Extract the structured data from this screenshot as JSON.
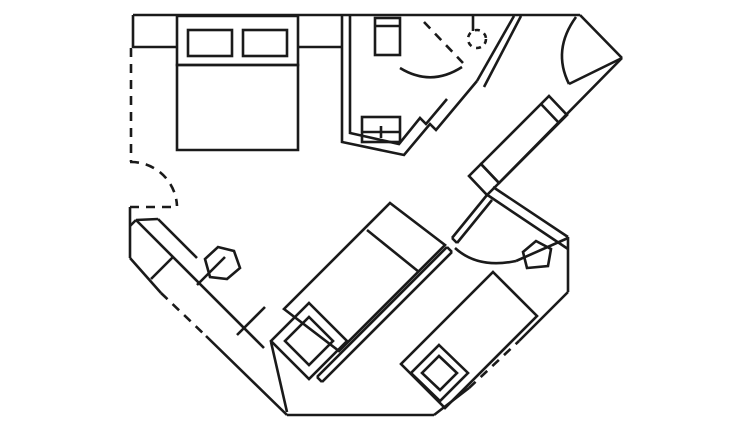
{
  "canvas": {
    "width": 754,
    "height": 435,
    "background_color": "#ffffff",
    "line_color": "#1a1a1a",
    "line_width": 2.6,
    "dash_pattern": "9,7",
    "dash_pattern_small": "5,5"
  },
  "floor_plan": {
    "elements": [
      {
        "name": "top-wall",
        "type": "line",
        "x1": 133,
        "y1": 15,
        "x2": 580,
        "y2": 15
      },
      {
        "name": "left-wall-top",
        "type": "line",
        "x1": 133,
        "y1": 15,
        "x2": 133,
        "y2": 48
      },
      {
        "name": "left-wall-window-dashed",
        "type": "line",
        "dashed": true,
        "x1": 131,
        "y1": 48,
        "x2": 131,
        "y2": 162
      },
      {
        "name": "left-connecting-door-leaf-dashed",
        "type": "line",
        "dashed": true,
        "x1": 130,
        "y1": 207,
        "x2": 177,
        "y2": 207
      },
      {
        "name": "left-connecting-door-arc-dashed",
        "type": "path",
        "dashed": true,
        "d": "M130,162 A46,46 0 0 1 177,206"
      },
      {
        "name": "left-wall-bottom",
        "type": "line",
        "x1": 130,
        "y1": 207,
        "x2": 130,
        "y2": 258
      },
      {
        "name": "lower-left-wall-a",
        "type": "line",
        "x1": 130,
        "y1": 258,
        "x2": 161,
        "y2": 293
      },
      {
        "name": "lower-left-window-dashed",
        "type": "line",
        "dashed": true,
        "x1": 161,
        "y1": 293,
        "x2": 206,
        "y2": 336
      },
      {
        "name": "lower-left-wall-b",
        "type": "line",
        "x1": 206,
        "y1": 336,
        "x2": 287,
        "y2": 415
      },
      {
        "name": "bottom-wall",
        "type": "line",
        "x1": 287,
        "y1": 415,
        "x2": 434,
        "y2": 415
      },
      {
        "name": "lower-right-wall-a",
        "type": "line",
        "x1": 434,
        "y1": 415,
        "x2": 469,
        "y2": 388
      },
      {
        "name": "lower-right-window-dashed",
        "type": "line",
        "dashed": true,
        "x1": 469,
        "y1": 388,
        "x2": 519,
        "y2": 341
      },
      {
        "name": "lower-right-wall-b",
        "type": "line",
        "x1": 519,
        "y1": 341,
        "x2": 568,
        "y2": 292
      },
      {
        "name": "right-wall-vertical",
        "type": "line",
        "x1": 568,
        "y1": 237,
        "x2": 568,
        "y2": 292
      },
      {
        "name": "entry-corner-wall",
        "type": "line",
        "x1": 580,
        "y1": 15,
        "x2": 622,
        "y2": 58
      },
      {
        "name": "entry-door-leaf",
        "type": "line",
        "x1": 622,
        "y1": 58,
        "x2": 569,
        "y2": 84
      },
      {
        "name": "entry-door-arc",
        "type": "path",
        "d": "M576,17 Q552,50 569,84"
      },
      {
        "name": "right-diagonal-wall",
        "type": "line",
        "x1": 622,
        "y1": 58,
        "x2": 499,
        "y2": 183
      },
      {
        "name": "wardrobe",
        "type": "polygon",
        "pts": "549,96 567,115 499,183 481,164"
      },
      {
        "name": "wardrobe-divider",
        "type": "line",
        "x1": 541,
        "y1": 104,
        "x2": 559,
        "y2": 123
      },
      {
        "name": "wall-connector-post",
        "type": "polygon",
        "pts": "481,164 499,183 487,195 469,176"
      },
      {
        "name": "room2-north-wall-outer",
        "type": "line",
        "x1": 493,
        "y1": 187,
        "x2": 568,
        "y2": 237
      },
      {
        "name": "room2-north-wall-inner",
        "type": "line",
        "x1": 486,
        "y1": 194,
        "x2": 568,
        "y2": 249
      },
      {
        "name": "room2-west-wall-outer",
        "type": "line",
        "x1": 487,
        "y1": 195,
        "x2": 452,
        "y2": 238
      },
      {
        "name": "room2-west-wall-inner",
        "type": "line",
        "x1": 492,
        "y1": 200,
        "x2": 457,
        "y2": 243
      },
      {
        "name": "room2-west-wall-cap",
        "type": "line",
        "x1": 452,
        "y1": 238,
        "x2": 457,
        "y2": 243
      },
      {
        "name": "room2-door-arc",
        "type": "path",
        "d": "M455,248 Q478,269 516,261"
      },
      {
        "name": "room2-corner-wall",
        "type": "line",
        "x1": 516,
        "y1": 261,
        "x2": 568,
        "y2": 238
      },
      {
        "name": "bathroom-wall-outer",
        "type": "path",
        "d": "M342,16 L342,142 L404,155 L430,124 L436,130 L477,81"
      },
      {
        "name": "bathroom-wall-inner",
        "type": "path",
        "d": "M350,16 L350,133 L399,144 L420,118 L426,124 L447,99"
      },
      {
        "name": "corridor-wall-outer",
        "type": "line",
        "x1": 514,
        "y1": 16,
        "x2": 477,
        "y2": 81
      },
      {
        "name": "corridor-wall-inner",
        "type": "line",
        "x1": 521,
        "y1": 16,
        "x2": 484,
        "y2": 87
      },
      {
        "name": "bathroom-door-arc",
        "type": "path",
        "d": "M400,68 Q431,87 462,67"
      },
      {
        "name": "toilet",
        "type": "rect",
        "x": 375,
        "y": 18,
        "w": 25,
        "h": 37
      },
      {
        "name": "toilet-tank-line",
        "type": "line",
        "x1": 375,
        "y1": 26,
        "x2": 400,
        "y2": 26
      },
      {
        "name": "washbasin",
        "type": "rect",
        "x": 362,
        "y": 117,
        "w": 38,
        "h": 25
      },
      {
        "name": "washbasin-line",
        "type": "line",
        "x1": 362,
        "y1": 132,
        "x2": 400,
        "y2": 132
      },
      {
        "name": "washbasin-tap",
        "type": "line",
        "x1": 381,
        "y1": 126,
        "x2": 381,
        "y2": 138
      },
      {
        "name": "shower-divider-dashed",
        "type": "line",
        "dashed": true,
        "x1": 424,
        "y1": 22,
        "x2": 463,
        "y2": 63
      },
      {
        "name": "shower-head-circle-dashed",
        "type": "circle",
        "dashed_small": true,
        "cx": 477,
        "cy": 39,
        "r": 9
      },
      {
        "name": "shower-pipe",
        "type": "line",
        "x1": 473,
        "y1": 16,
        "x2": 473,
        "y2": 31
      },
      {
        "name": "headboard-shelf",
        "type": "polygon",
        "pts": "177,16 298,16 298,65 177,65"
      },
      {
        "name": "pillow-left",
        "type": "rect",
        "x": 188,
        "y": 30,
        "w": 44,
        "h": 26
      },
      {
        "name": "pillow-right",
        "type": "rect",
        "x": 243,
        "y": 30,
        "w": 44,
        "h": 26
      },
      {
        "name": "double-bed",
        "type": "polygon",
        "pts": "177,65 298,65 298,150 177,150"
      },
      {
        "name": "nightstand-left-line",
        "type": "line",
        "x1": 133,
        "y1": 47,
        "x2": 177,
        "y2": 47
      },
      {
        "name": "nightstand-right-line",
        "type": "line",
        "x1": 298,
        "y1": 47,
        "x2": 343,
        "y2": 47
      },
      {
        "name": "sofa",
        "type": "polygon",
        "pts": "390,203 445,245 339,351 284,309"
      },
      {
        "name": "sofa-divider",
        "type": "line",
        "x1": 367,
        "y1": 230,
        "x2": 419,
        "y2": 272
      },
      {
        "name": "sofa-ledge-outer",
        "type": "line",
        "x1": 447,
        "y1": 247,
        "x2": 317,
        "y2": 377
      },
      {
        "name": "sofa-ledge-inner",
        "type": "line",
        "x1": 452,
        "y1": 252,
        "x2": 322,
        "y2": 382
      },
      {
        "name": "sofa-ledge-cap-top",
        "type": "line",
        "x1": 447,
        "y1": 247,
        "x2": 452,
        "y2": 252
      },
      {
        "name": "sofa-ledge-cap-bottom",
        "type": "line",
        "x1": 317,
        "y1": 377,
        "x2": 322,
        "y2": 382
      },
      {
        "name": "side-table-left-outer",
        "type": "polygon",
        "pts": "309,303 347,341 309,379 271,341"
      },
      {
        "name": "side-table-left-inner",
        "type": "polygon",
        "pts": "309,317 333,341 309,365 285,341"
      },
      {
        "name": "side-table-right-outer",
        "type": "polygon",
        "pts": "439,345 468,373 440,401 411,373"
      },
      {
        "name": "side-table-right-inner",
        "type": "polygon",
        "pts": "439,356 457,373 440,390 422,373"
      },
      {
        "name": "bed2",
        "type": "polygon",
        "pts": "493,272 537,316 445,408 401,364"
      },
      {
        "name": "corner-basin",
        "type": "polygon",
        "pts": "527,268 523,252 536,241 551,249 548,266"
      },
      {
        "name": "desk-front-line",
        "type": "line",
        "x1": 136,
        "y1": 220,
        "x2": 264,
        "y2": 348
      },
      {
        "name": "desk-inner-line",
        "type": "line",
        "x1": 158,
        "y1": 219,
        "x2": 197,
        "y2": 258
      },
      {
        "name": "desk-top-cap",
        "type": "line",
        "x1": 136,
        "y1": 220,
        "x2": 158,
        "y2": 219
      },
      {
        "name": "desk-left-cap",
        "type": "line",
        "x1": 136,
        "y1": 220,
        "x2": 130,
        "y2": 226
      },
      {
        "name": "desk-divider-1",
        "type": "line",
        "x1": 173,
        "y1": 257,
        "x2": 151,
        "y2": 279
      },
      {
        "name": "desk-divider-2",
        "type": "line",
        "x1": 225,
        "y1": 257,
        "x2": 197,
        "y2": 285
      },
      {
        "name": "desk-divider-3",
        "type": "line",
        "x1": 265,
        "y1": 307,
        "x2": 237,
        "y2": 335
      },
      {
        "name": "desk-tip-line",
        "type": "line",
        "x1": 271,
        "y1": 342,
        "x2": 287,
        "y2": 412
      },
      {
        "name": "desk-chair",
        "type": "polygon",
        "pts": "210,277 205,259 218,247 234,251 240,268 227,279"
      }
    ]
  }
}
